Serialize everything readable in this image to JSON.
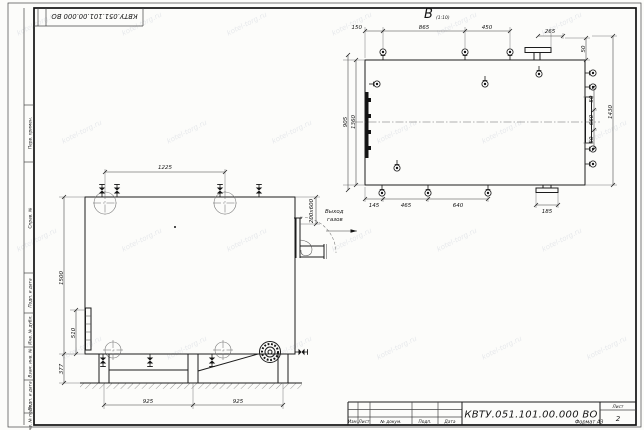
{
  "colors": {
    "paper": "#fcfcfa",
    "ink": "#1c1c1c"
  },
  "watermark": {
    "text": "kotel-torg.ru"
  },
  "stamp_top": {
    "doc_number": "КВТУ.051.101.00.000  ВО"
  },
  "frame_labels": {
    "perv_primen": "Перв. примен.",
    "sprav_no": "Справ. №",
    "podp_data_1": "Подп. и дата",
    "inv_dubl": "Инв. № дубл.",
    "vzam_inv": "Взам. инв. №",
    "podp_data_2": "Подп. и дата",
    "inv_podl": "Инв. № подл."
  },
  "title_block": {
    "doc_number": "КВТУ.051.101.00.000  ВО",
    "col_izm": "Изм.",
    "col_list": "Лист",
    "col_doc": "№ докум.",
    "col_podp": "Подп.",
    "col_data": "Дата",
    "sheet_label": "Лист",
    "sheet_number": "2",
    "format_label": "Формат  А3"
  },
  "front_view": {
    "dim_top_width": "1225",
    "dim_height": "1500",
    "dim_gauge": "510",
    "dim_legs": "377",
    "dim_span_left": "925",
    "dim_span_right": "925",
    "dim_outlet": "200х600",
    "outlet_label_1": "Выход",
    "outlet_label_2": "газов"
  },
  "top_view": {
    "view_label": "В",
    "view_scale": "(1:10)",
    "dim_150": "150",
    "dim_865": "865",
    "dim_450": "450",
    "dim_265": "265",
    "dim_50_top": "50",
    "dim_50_a": "50",
    "dim_660": "660",
    "dim_50_b": "50",
    "dim_1430": "1430",
    "dim_145": "145",
    "dim_465": "465",
    "dim_640": "640",
    "dim_185": "185",
    "dim_905": "905",
    "dim_1360": "1360"
  }
}
